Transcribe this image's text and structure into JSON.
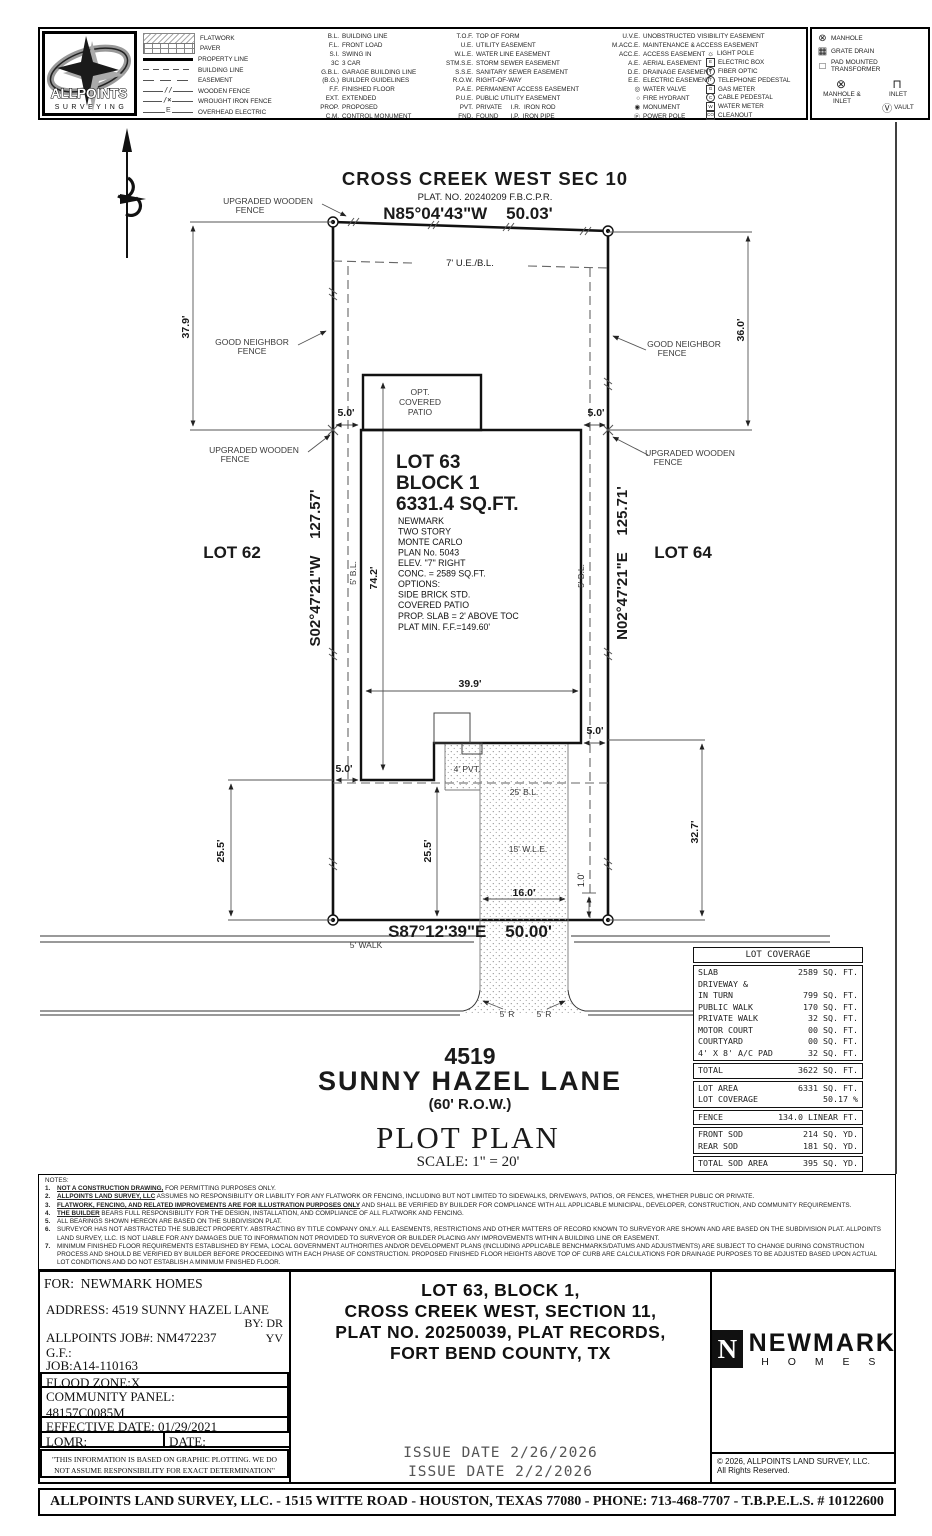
{
  "brand": {
    "name_line1": "ALLPOINTS",
    "name_line2": "SURVEYING"
  },
  "legend": {
    "samples": [
      {
        "kind": "flatwork",
        "label": "FLATWORK"
      },
      {
        "kind": "paver",
        "label": "PAVER"
      },
      {
        "kind": "property",
        "label": "PROPERTY LINE"
      },
      {
        "kind": "building",
        "label": "BUILDING LINE"
      },
      {
        "kind": "easement",
        "label": "EASEMENT"
      },
      {
        "kind": "wood",
        "label": "WOODEN FENCE"
      },
      {
        "kind": "iron",
        "label": "WROUGHT IRON FENCE"
      },
      {
        "kind": "ohe",
        "label": "OVERHEAD ELECTRIC"
      }
    ],
    "col1": [
      {
        "abbr": "B.L.",
        "label": "BUILDING LINE"
      },
      {
        "abbr": "F.L.",
        "label": "FRONT LOAD"
      },
      {
        "abbr": "S.I.",
        "label": "SWING IN"
      },
      {
        "abbr": "3C",
        "label": "3 CAR"
      },
      {
        "abbr": "G.B.L.",
        "label": "GARAGE BUILDING LINE"
      },
      {
        "abbr": "(B.G.)",
        "label": "BUILDER GUIDELINES"
      },
      {
        "abbr": "F.F.",
        "label": "FINISHED FLOOR"
      },
      {
        "abbr": "EXT.",
        "label": "EXTENDED"
      },
      {
        "abbr": "PROP.",
        "label": "PROPOSED"
      },
      {
        "abbr": "C.M.",
        "label": "CONTROL MONUMENT"
      }
    ],
    "col2": [
      {
        "abbr": "T.O.F.",
        "label": "TOP OF FORM"
      },
      {
        "abbr": "U.E.",
        "label": "UTILITY EASEMENT"
      },
      {
        "abbr": "W.L.E.",
        "label": "WATER LINE EASEMENT"
      },
      {
        "abbr": "STM.S.E.",
        "label": "STORM SEWER EASEMENT"
      },
      {
        "abbr": "S.S.E.",
        "label": "SANITARY SEWER EASEMENT"
      },
      {
        "abbr": "R.O.W.",
        "label": "RIGHT-OF-WAY"
      },
      {
        "abbr": "P.A.E.",
        "label": "PERMANENT ACCESS EASEMENT"
      },
      {
        "abbr": "P.U.E.",
        "label": "PUBLIC UTILITY EASEMENT"
      },
      {
        "abbr": "PVT.",
        "label": "PRIVATE     I.R.  IRON ROD"
      },
      {
        "abbr": "FND.",
        "label": "FOUND       I.P.  IRON PIPE"
      }
    ],
    "col3": [
      {
        "abbr": "U.V.E.",
        "label": "UNOBSTRUCTED VISIBILITY EASEMENT"
      },
      {
        "abbr": "M.ACC.E.",
        "label": "MAINTENANCE & ACCESS EASEMENT"
      },
      {
        "abbr": "ACC.E.",
        "label": "ACCESS EASEMENT"
      },
      {
        "abbr": "A.E.",
        "label": "AERIAL EASEMENT"
      },
      {
        "abbr": "D.E.",
        "label": "DRAINAGE EASEMENT"
      },
      {
        "abbr": "E.E.",
        "label": "ELECTRIC EASEMENT"
      },
      {
        "abbr": "◎",
        "label": "WATER VALVE"
      },
      {
        "abbr": "○",
        "label": "FIRE HYDRANT"
      },
      {
        "abbr": "◉",
        "label": "MONUMENT"
      },
      {
        "abbr": "Ⓟ",
        "label": "POWER POLE"
      }
    ],
    "col4": [
      {
        "sym": "☼",
        "label": "LIGHT POLE",
        "box": "symplain"
      },
      {
        "sym": "E",
        "label": "ELECTRIC BOX",
        "box": "symsq"
      },
      {
        "sym": "F",
        "label": "FIBER OPTIC",
        "box": "symci"
      },
      {
        "sym": "T",
        "label": "TELEPHONE PEDESTAL",
        "box": "symci"
      },
      {
        "sym": "G",
        "label": "GAS METER",
        "box": "symsq"
      },
      {
        "sym": "C",
        "label": "CABLE PEDESTAL",
        "box": "symci"
      },
      {
        "sym": "W",
        "label": "WATER METER",
        "box": "symsq"
      },
      {
        "sym": "CO",
        "label": "CLEANOUT",
        "box": "symsq"
      }
    ],
    "right": [
      {
        "sym": "⊗",
        "label": "MANHOLE"
      },
      {
        "sym": "▦",
        "label": "GRATE DRAIN"
      },
      {
        "sym": "□",
        "label": "PAD MOUNTED TRANSFORMER"
      },
      {
        "sym": "⊗",
        "label": "MANHOLE & INLET"
      },
      {
        "sym": "⊓",
        "label": "INLET"
      },
      {
        "sym": "Ⓥ",
        "label": "VAULT"
      }
    ]
  },
  "plan": {
    "subdivision": "CROSS CREEK WEST SEC 10",
    "plat": "PLAT. NO. 20240209 F.B.C.P.R.",
    "brg_top": "N85°04'43\"W    50.03'",
    "brg_left": "S02°47'21\"W    127.57'",
    "brg_right": "N02°47'21\"E    125.71'",
    "brg_bottom": "S87°12'39\"E    50.00'",
    "ue_bl": "7' U.E./B.L.",
    "lbl_upgraded": "UPGRADED WOODEN",
    "lbl_goodneighbor": "GOOD NEIGHBOR",
    "lbl_fence": "FENCE",
    "d379": "37.9'",
    "d360": "36.0'",
    "d742": "74.2'",
    "d399": "39.9'",
    "d50": "5.0'",
    "d255": "25.5'",
    "d327": "32.7'",
    "d160": "16.0'",
    "d10": "1.0'",
    "lot62": "LOT 62",
    "lot64": "LOT 64",
    "lot63": "LOT 63",
    "block1": "BLOCK 1",
    "sqft": "6331.4 SQ.FT.",
    "bl5": "5' B.L.",
    "bl25": "25' B.L.",
    "wle15": "15' W.L.E.",
    "pvt4": "4' PVT.",
    "walk5": "5' WALK",
    "r5": "5' R",
    "house_lines": [
      "NEWMARK",
      "TWO STORY",
      "MONTE CARLO",
      "PLAN No. 5043",
      "ELEV. \"7\" RIGHT",
      "CONC. = 2589 SQ.FT.",
      "OPTIONS:",
      "SIDE BRICK STD.",
      "COVERED PATIO",
      "PROP. SLAB = 2' ABOVE TOC",
      "PLAT MIN. F.F.=149.60'"
    ],
    "patio1": "OPT.",
    "patio2": "COVERED",
    "patio3": "PATIO",
    "street_no": "4519",
    "street_name": "SUNNY HAZEL LANE",
    "row60": "(60' R.O.W.)",
    "plot_plan": "PLOT PLAN",
    "scale": "SCALE: 1\" = 20'"
  },
  "coverage": {
    "title": "LOT COVERAGE",
    "rows": [
      {
        "l": "SLAB",
        "v": "2589 SQ. FT."
      },
      {
        "l": "DRIVEWAY &",
        "v": ""
      },
      {
        "l": "IN TURN",
        "v": "799 SQ. FT."
      },
      {
        "l": "PUBLIC WALK",
        "v": "170 SQ. FT."
      },
      {
        "l": "PRIVATE WALK",
        "v": "32 SQ. FT."
      },
      {
        "l": "MOTOR COURT",
        "v": "00 SQ. FT."
      },
      {
        "l": "COURTYARD",
        "v": "00 SQ. FT."
      },
      {
        "l": "4' X 8' A/C PAD",
        "v": "32 SQ. FT."
      }
    ],
    "total": {
      "l": "TOTAL",
      "v": "3622 SQ. FT."
    },
    "area": [
      {
        "l": "LOT AREA",
        "v": "6331 SQ. FT."
      },
      {
        "l": "LOT COVERAGE",
        "v": "50.17 %"
      }
    ],
    "fence": {
      "l": "FENCE",
      "v": "134.0 LINEAR FT."
    },
    "sod": [
      {
        "l": "FRONT SOD",
        "v": "214 SQ. YD."
      },
      {
        "l": "REAR SOD",
        "v": "181 SQ. YD."
      }
    ],
    "sod_total": {
      "l": "TOTAL SOD AREA",
      "v": "395 SQ. YD."
    }
  },
  "notes": {
    "title": "NOTES:",
    "items": [
      {
        "n": "1.",
        "b": "NOT A CONSTRUCTION DRAWING,",
        "t": " FOR PERMITTING PURPOSES ONLY."
      },
      {
        "n": "2.",
        "b": "ALLPOINTS LAND SURVEY, LLC",
        "t": " ASSUMES NO RESPONSIBILITY OR LIABILITY FOR ANY FLATWORK OR FENCING, INCLUDING BUT NOT LIMITED TO SIDEWALKS, DRIVEWAYS, PATIOS, OR FENCES, WHETHER PUBLIC OR PRIVATE."
      },
      {
        "n": "3.",
        "b": "FLATWORK, FENCING, AND RELATED IMPROVEMENTS ARE FOR ILLUSTRATION PURPOSES ONLY",
        "t": " AND SHALL BE VERIFIED BY BUILDER FOR COMPLIANCE WITH ALL APPLICABLE MUNICIPAL, DEVELOPER, CONSTRUCTION, AND COMMUNITY REQUIREMENTS."
      },
      {
        "n": "4.",
        "b": "THE BUILDER",
        "t": " BEARS FULL RESPONSIBILITY FOR THE DESIGN, INSTALLATION, AND COMPLIANCE OF ALL FLATWORK AND FENCING."
      },
      {
        "n": "5.",
        "b": "",
        "t": "ALL BEARINGS SHOWN HEREON ARE BASED ON THE SUBDIVISION PLAT."
      },
      {
        "n": "6.",
        "b": "",
        "t": "SURVEYOR HAS NOT ABSTRACTED THE SUBJECT PROPERTY. ABSTRACTING BY TITLE COMPANY ONLY. ALL EASEMENTS, RESTRICTIONS AND OTHER MATTERS OF RECORD KNOWN TO SURVEYOR ARE SHOWN AND ARE BASED ON THE SUBDIVISION PLAT. ALLPOINTS LAND SURVEY, LLC. IS NOT LIABLE FOR ANY DAMAGES DUE TO INFORMATION NOT PROVIDED TO SURVEYOR OR BUILDER PLACING ANY IMPROVEMENTS WITHIN A BUILDING LINE OR EASEMENT."
      },
      {
        "n": "7.",
        "b": "",
        "t": "MINIMUM FINISHED FLOOR REQUIREMENTS ESTABLISHED BY FEMA, LOCAL GOVERNMENT AUTHORITIES AND/OR DEVELOPMENT PLANS (INCLUDING APPLICABLE BENCHMARKS/DATUMS AND ADJUSTMENTS) ARE SUBJECT TO CHANGE DURING CONSTRUCTION PROCESS AND SHOULD BE VERIFIED BY BUILDER BEFORE PROCEEDING WITH EACH PHASE OF CONSTRUCTION.  PROPOSED FINISHED FLOOR HEIGHTS ABOVE TOP OF CURB ARE CALCULATIONS FOR DRAINAGE PURPOSES TO BE ADJUSTED BASED UPON ACTUAL LOT CONDITIONS AND DO NOT ESTABLISH A MINIMUM FINISHED FLOOR."
      }
    ]
  },
  "info": {
    "for_line": "FOR:  NEWMARK HOMES",
    "address": "ADDRESS: 4519 SUNNY HAZEL LANE",
    "by": "BY: DR",
    "by2": "YV",
    "job_line": "ALLPOINTS JOB#: NM472237",
    "gf": "G.F.:",
    "job2": "JOB:A14-110163",
    "flood": "FLOOD ZONE:X",
    "panel_label": "COMMUNITY PANEL:",
    "panel_value": "48157C0085M",
    "effective": "EFFECTIVE DATE: 01/29/2021",
    "lomr": "LOMR:",
    "date": "DATE:",
    "disclaimer1": "\"THIS INFORMATION IS BASED ON GRAPHIC PLOTTING.  WE DO",
    "disclaimer2": "NOT ASSUME RESPONSIBILITY FOR EXACT DETERMINATION\""
  },
  "legal": {
    "line1": "LOT 63, BLOCK 1,",
    "line2": "CROSS CREEK WEST, SECTION 11,",
    "line3": "PLAT NO. 20250039, PLAT RECORDS,",
    "line4": "FORT BEND COUNTY, TX"
  },
  "issue": {
    "line1": "ISSUE DATE 2/26/2026",
    "line2": "ISSUE DATE 2/2/2026"
  },
  "newmark": {
    "n": "N",
    "name": "NEWMARK",
    "homes": "H O M E S"
  },
  "copyright": {
    "line1": "© 2026, ALLPOINTS LAND SURVEY, LLC.",
    "line2": "All Rights Reserved."
  },
  "footer": "ALLPOINTS LAND SURVEY, LLC. - 1515 WITTE ROAD - HOUSTON, TEXAS 77080 - PHONE: 713-468-7707 - T.B.P.E.L.S. # 10122600"
}
